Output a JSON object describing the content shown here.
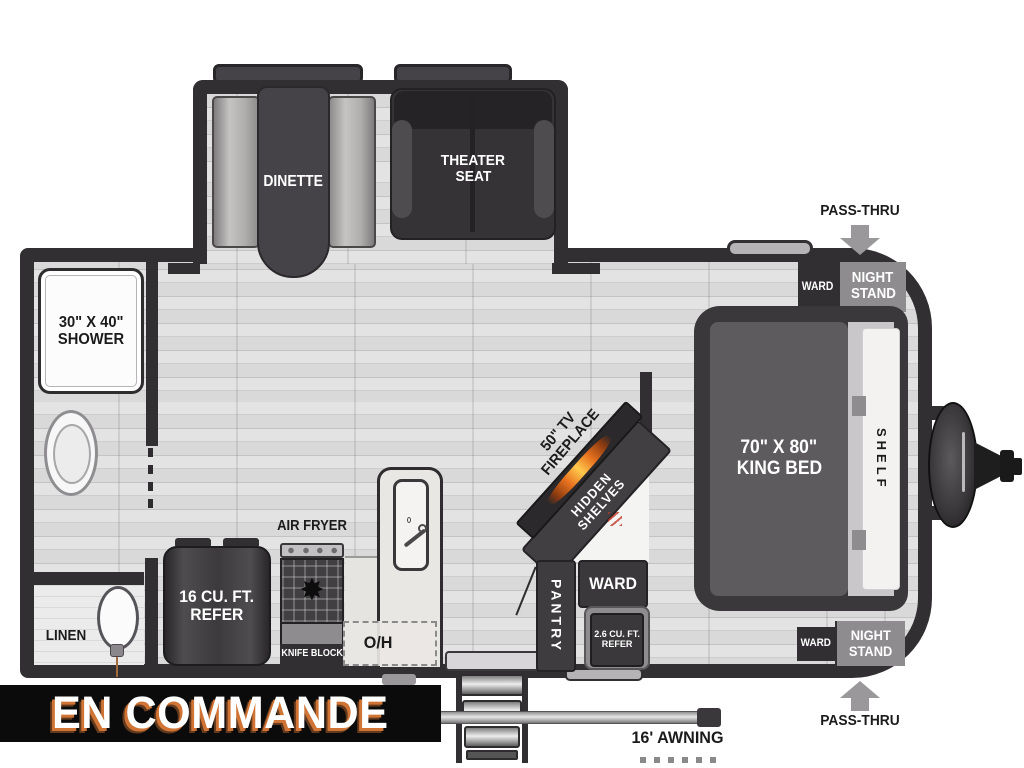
{
  "status_banner": {
    "label": "EN COMMANDE"
  },
  "exterior": {
    "pass_thru_top": "PASS-THRU",
    "pass_thru_bottom": "PASS-THRU",
    "awning_label": "16' AWNING"
  },
  "slideout": {
    "dinette_label": "DINETTE",
    "theater_seat_line1": "THEATER",
    "theater_seat_line2": "SEAT"
  },
  "bathroom": {
    "shower_line1": "30\" X 40\"",
    "shower_line2": "SHOWER",
    "linen_label": "LINEN"
  },
  "kitchen": {
    "air_fryer_label": "AIR FRYER",
    "knife_block_label": "KNIFE BLOCK",
    "overhead_label": "O/H",
    "refer_line1": "16 CU. FT.",
    "refer_line2": "REFER"
  },
  "entertainment": {
    "tv_line1": "50\" TV",
    "tv_line2": "FIREPLACE",
    "hidden_line1": "HIDDEN",
    "hidden_line2": "SHELVES",
    "pantry_label": "PANTRY",
    "ward_label": "WARD",
    "refer_line1": "2.6 CU. FT.",
    "refer_line2": "REFER"
  },
  "bedroom": {
    "bed_line1": "70\" X 80\"",
    "bed_line2": "KING BED",
    "shelf_label": "SHELF",
    "ward_top_label": "WARD",
    "nightstand_top_line1": "NIGHT",
    "nightstand_top_line2": "STAND",
    "ward_bottom_label": "WARD",
    "nightstand_bottom_line1": "NIGHT",
    "nightstand_bottom_line2": "STAND"
  },
  "colors": {
    "wall": "#312f31",
    "floor": "#d9d9d9",
    "furniture_dark": "#3a383a",
    "furniture_gray": "#8e8c8f",
    "banner_bg": "#0b0b0b",
    "banner_text": "#ffffff",
    "banner_accent": "#cf7434",
    "flame_orange": "#e8731f"
  }
}
